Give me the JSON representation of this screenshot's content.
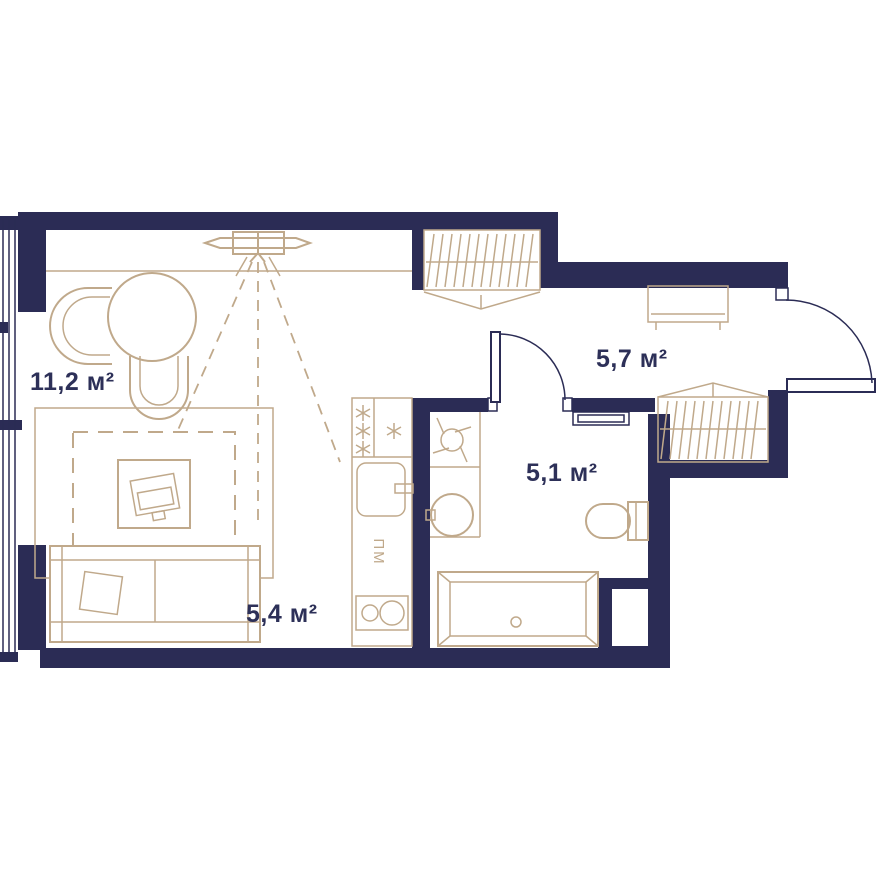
{
  "plan": {
    "title": "studio-apartment-floor-plan",
    "rooms": [
      {
        "id": "living",
        "label": "11,2 м²"
      },
      {
        "id": "kitchen",
        "label": "5,4 м²"
      },
      {
        "id": "bathroom",
        "label": "5,1 м²"
      },
      {
        "id": "hallway",
        "label": "5,7 м²"
      }
    ],
    "appliance_labels": {
      "dishwasher": "ПМ"
    },
    "fridge_symbol": "three-star-freezer-icon",
    "colors": {
      "wall": "#2b2c55",
      "beige": "#c0a98b",
      "text": "#2d3058",
      "background": "#ffffff"
    },
    "elements": [
      "window-left",
      "entrance-door",
      "bathroom-door",
      "wall-tv",
      "dining-table",
      "chair",
      "chair",
      "rug",
      "coffee-table-laptop",
      "sofa",
      "wardrobe-living",
      "wardrobe-hallway",
      "console-table",
      "fridge",
      "kitchen-sink",
      "dishwasher",
      "cooktop",
      "washing-machine",
      "washbasin",
      "toilet",
      "bathtub",
      "wall-niche"
    ]
  }
}
